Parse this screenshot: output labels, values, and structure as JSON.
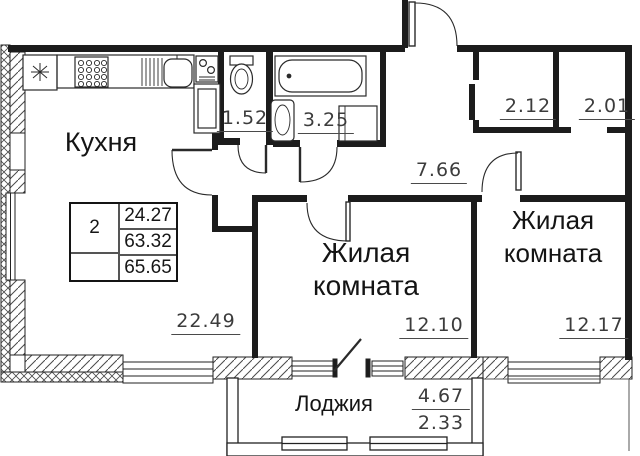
{
  "rooms": {
    "kitchen": {
      "label": "Кухня",
      "area": "22.49"
    },
    "living_mid": {
      "line1": "Жилая",
      "line2": "комната",
      "area": "12.10"
    },
    "living_right": {
      "line1": "Жилая",
      "line2": "комната",
      "area": "12.17"
    },
    "hallway": {
      "area": "7.66"
    },
    "wc": {
      "area": "1.52"
    },
    "bathroom": {
      "area": "3.25"
    },
    "closet_left": {
      "area": "2.12"
    },
    "closet_right": {
      "area": "2.01"
    },
    "loggia": {
      "label": "Лоджия",
      "area_full": "4.67",
      "area_reduced": "2.33"
    }
  },
  "info_table": {
    "rooms_count": "2",
    "living_area": "24.27",
    "area_without_loggia": "63.32",
    "total_area": "65.65"
  },
  "colors": {
    "wall": "#1c1c1c",
    "dim_text": "#3c3c3c",
    "label_text": "#141414"
  }
}
